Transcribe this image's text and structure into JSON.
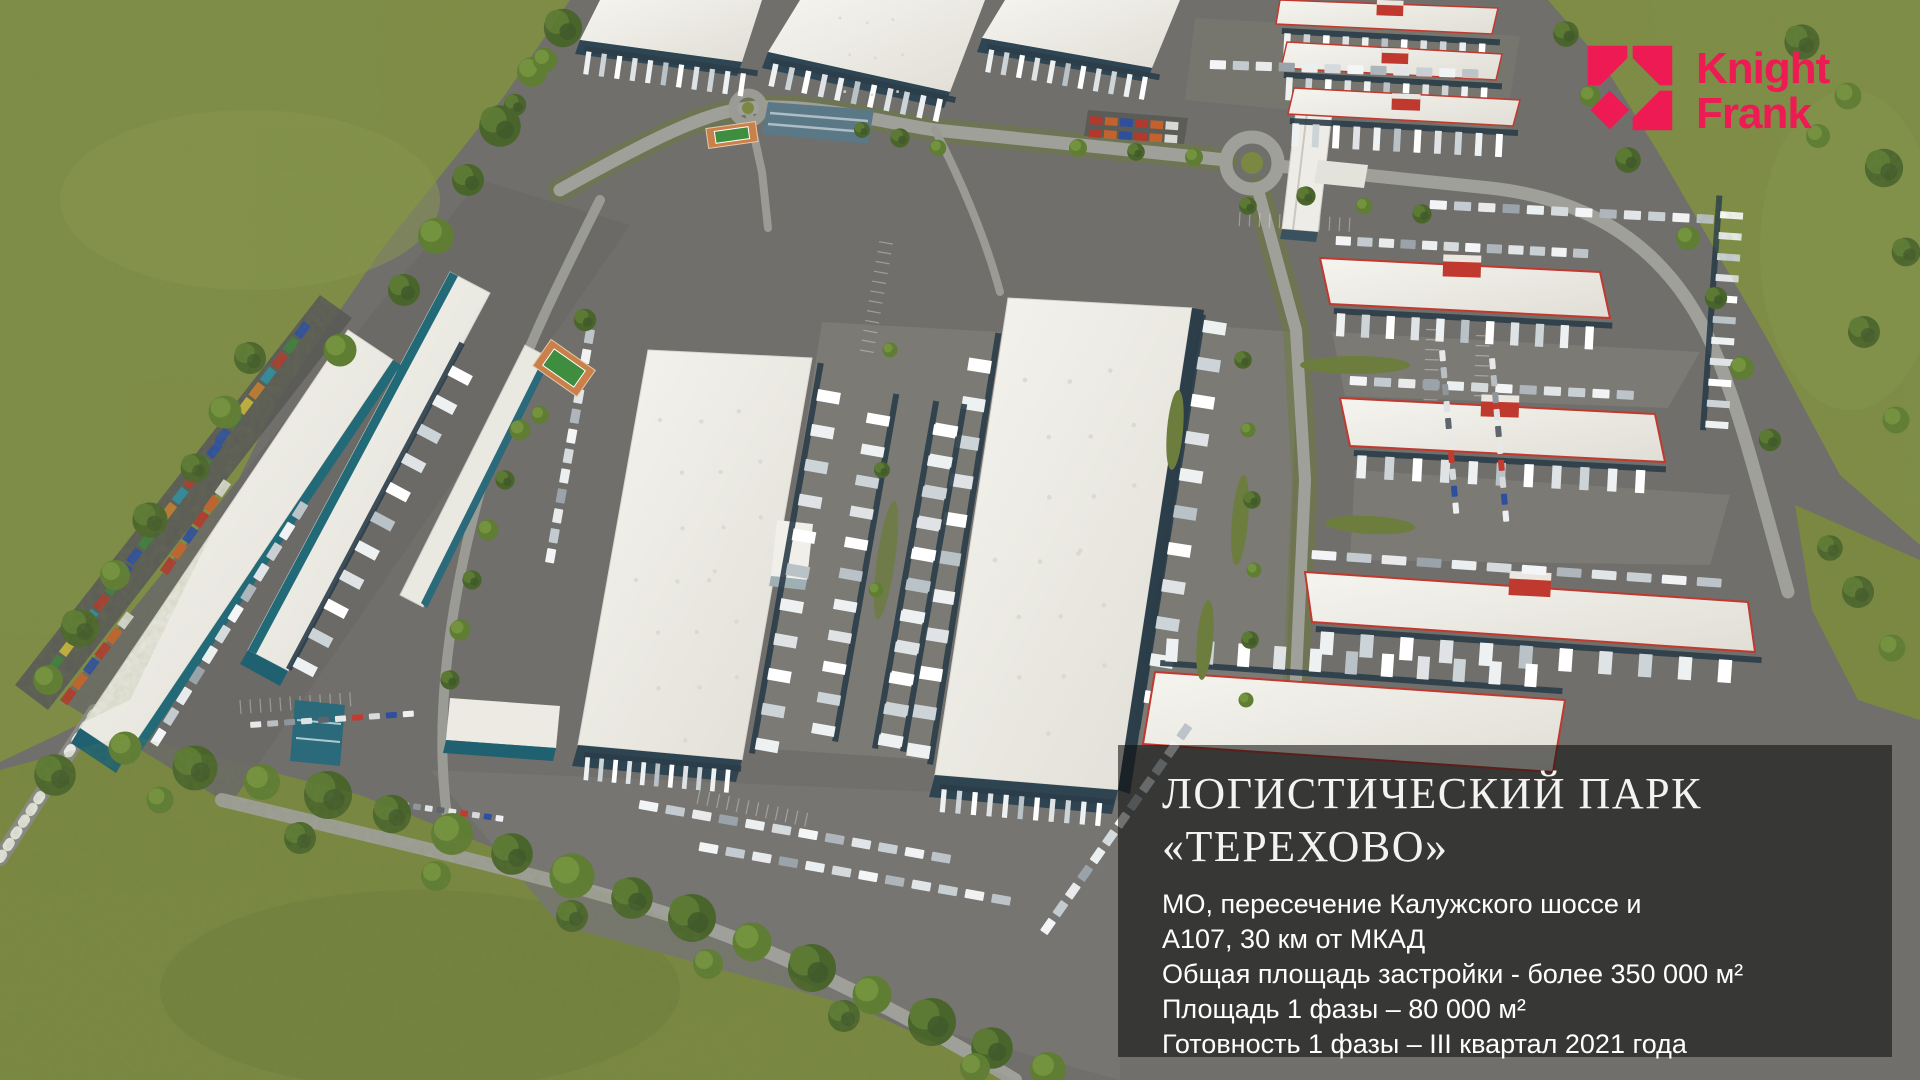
{
  "brand": {
    "name_line1": "Knight",
    "name_line2": "Frank",
    "accent_color": "#ed1a53"
  },
  "overlay": {
    "title_line1": "ЛОГИСТИЧЕСКИЙ ПАРК",
    "title_line2": "«ТЕРЕХОВО»",
    "details": [
      "МО, пересечение Калужского шоссе и",
      "А107, 30 км от МКАД",
      "Общая площадь застройки - более 350 000 м²",
      "Площадь 1 фазы – 80 000 м²",
      "Готовность 1 фазы – III квартал 2021 года"
    ],
    "panel_background": "rgba(12,12,12,0.57)"
  },
  "scene_colors": {
    "grass": "#7f8d46",
    "asphalt": "#706f6b",
    "road": "#a0a09a",
    "roof_white": "#f0efe9",
    "facade_blue": "#2f4451",
    "facade_teal": "#1f6170",
    "red_accent": "#c0392e",
    "tree_green": "#4a652c"
  }
}
